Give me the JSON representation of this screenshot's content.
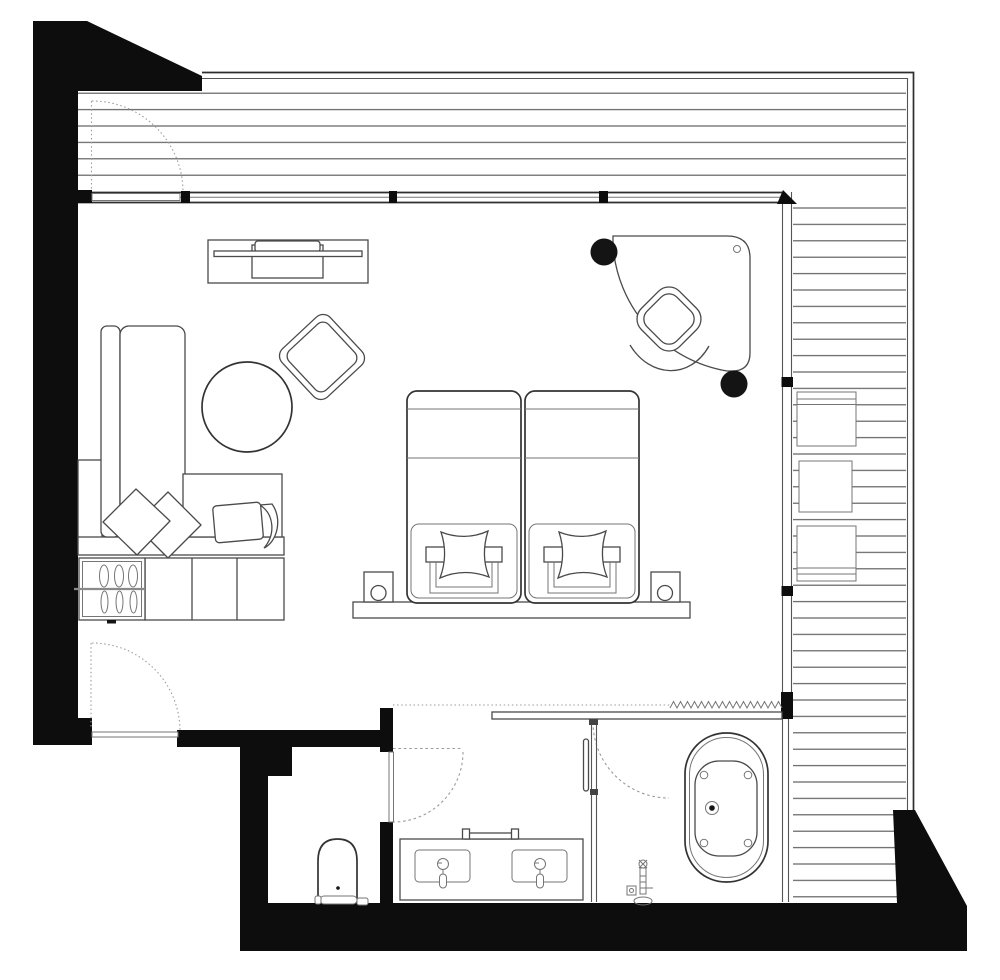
{
  "title": "hotel-suite-floor-plan",
  "palette": {
    "wall": "#0d0d0d",
    "paper": "#ffffff",
    "line": "#4a4a4a",
    "line-strong": "#333333",
    "line-light": "#757575",
    "deck-line": "#5a5a5a",
    "dash": "#9b9b9b"
  },
  "legend": {
    "zones": [
      "terrace-deck-north",
      "terrace-deck-east",
      "living-sleeping-room",
      "bathroom",
      "wc-room",
      "shower"
    ],
    "fixtures": [
      "entry-door",
      "terrace-door",
      "bathroom-door",
      "shower-door",
      "sofa-chaise",
      "sofa-pillows",
      "storage-cabinet",
      "coat-hooks",
      "round-table",
      "armchair",
      "tv-console",
      "twin-bed-left",
      "twin-bed-right",
      "bed-pillows",
      "nightstands",
      "table-lamps",
      "headboard-bench",
      "curved-desk",
      "desk-stools",
      "desk-chair",
      "double-vanity",
      "wash-basins",
      "faucets",
      "vanity-tray",
      "wall-shelf",
      "freestanding-bathtub",
      "tub-filler",
      "toilet",
      "glass-partition",
      "deck-cushion-boxes"
    ]
  }
}
